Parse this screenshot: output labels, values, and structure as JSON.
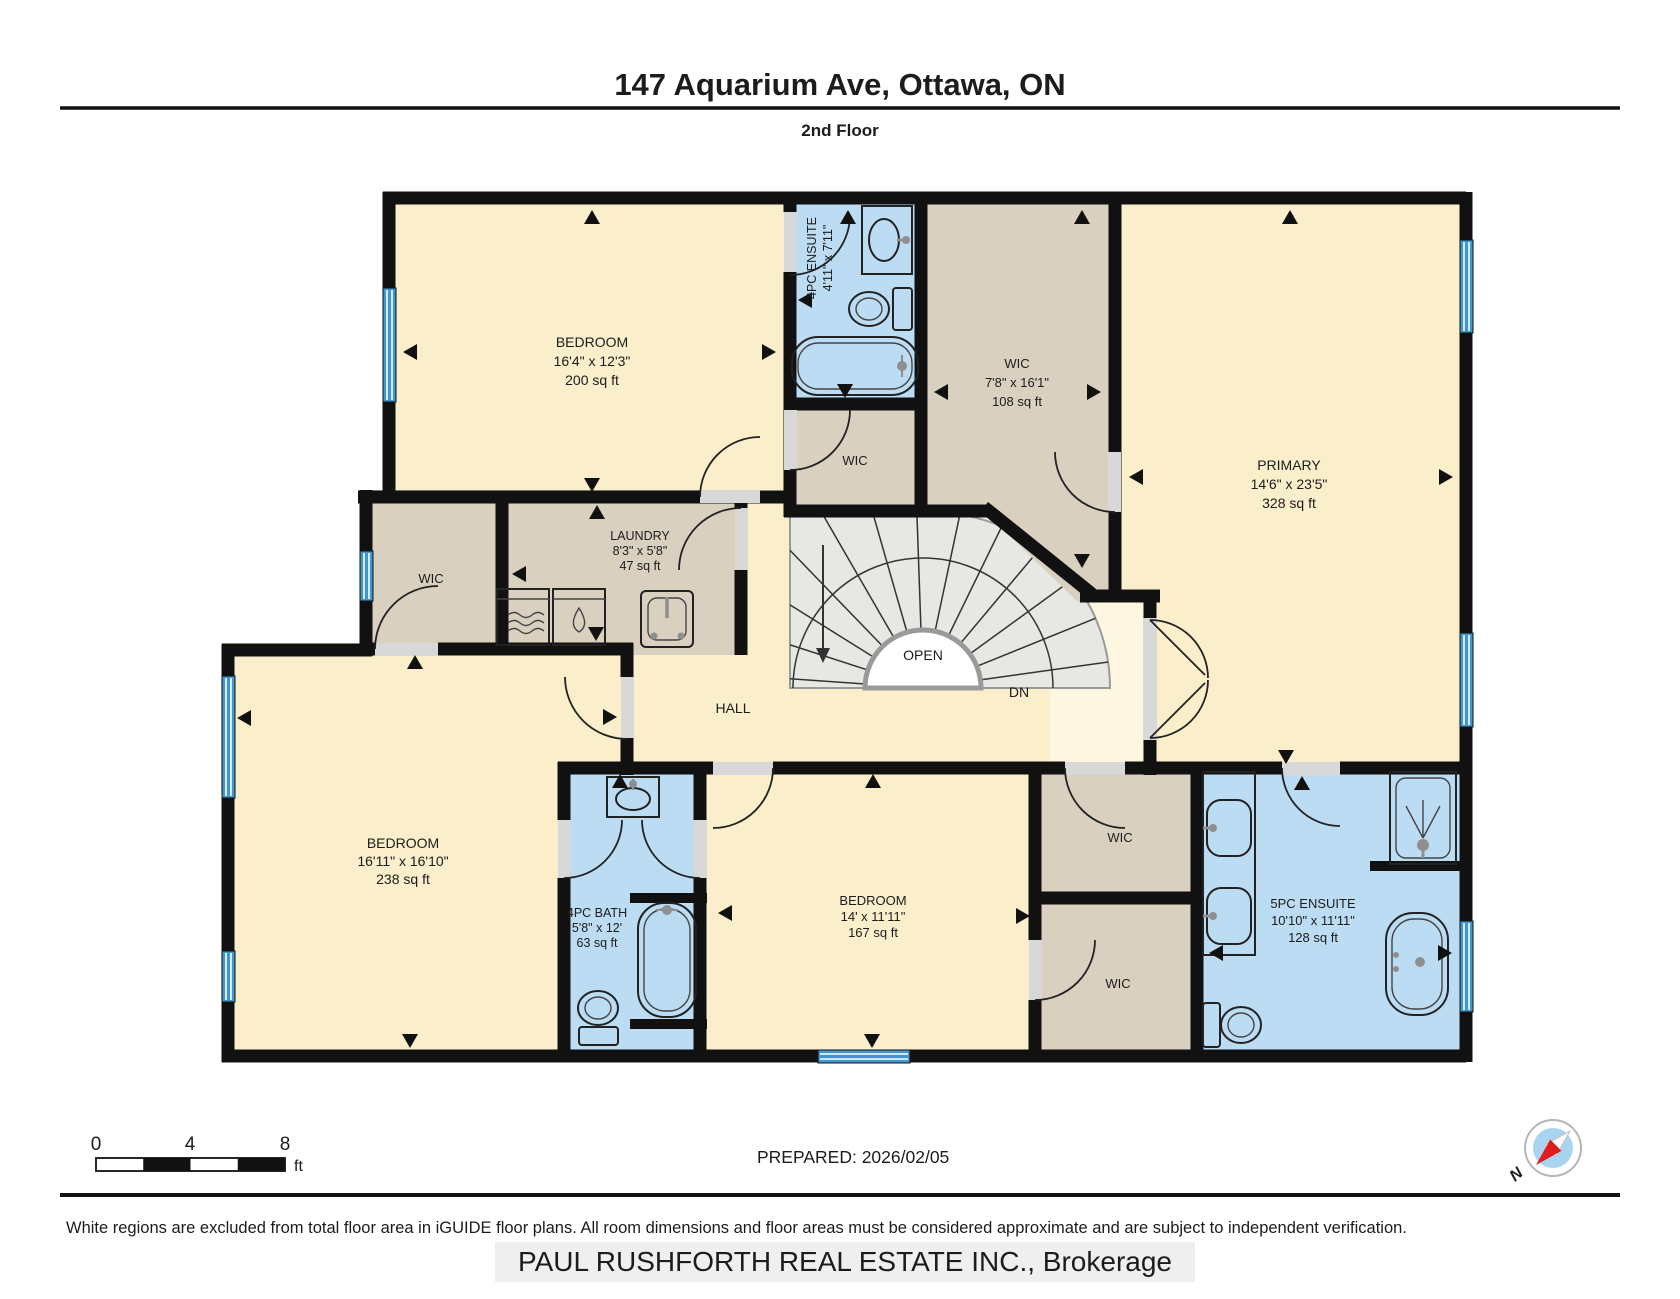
{
  "header": {
    "title": "147 Aquarium Ave, Ottawa, ON",
    "subtitle": "2nd Floor"
  },
  "rooms": {
    "bedroom_nw": {
      "name": "BEDROOM",
      "dims": "16'4\" x 12'3\"",
      "area": "200 sq ft"
    },
    "ensuite_4pc": {
      "name": "4PC ENSUITE",
      "dims": "4'11\" x 7'11\""
    },
    "wic_top": {
      "name": "WIC",
      "dims": "7'8\" x 16'1\"",
      "area": "108 sq ft"
    },
    "primary": {
      "name": "PRIMARY",
      "dims": "14'6\" x 23'5\"",
      "area": "328 sq ft"
    },
    "wic_mid": {
      "name": "WIC"
    },
    "wic_left": {
      "name": "WIC"
    },
    "laundry": {
      "name": "LAUNDRY",
      "dims": "8'3\" x 5'8\"",
      "area": "47 sq ft"
    },
    "hall": {
      "name": "HALL"
    },
    "stairs": {
      "open_label": "OPEN",
      "down_label": "DN"
    },
    "bedroom_sw": {
      "name": "BEDROOM",
      "dims": "16'11\" x 16'10\"",
      "area": "238 sq ft"
    },
    "bath_4pc": {
      "name": "4PC BATH",
      "dims": "5'8\" x 12'",
      "area": "63 sq ft"
    },
    "bedroom_s": {
      "name": "BEDROOM",
      "dims": "14' x 11'11\"",
      "area": "167 sq ft"
    },
    "wic_r_upper": {
      "name": "WIC"
    },
    "wic_r_lower": {
      "name": "WIC"
    },
    "ensuite_5pc": {
      "name": "5PC ENSUITE",
      "dims": "10'10\" x 11'11\"",
      "area": "128 sq ft"
    }
  },
  "legend": {
    "scale_ticks": [
      "0",
      "4",
      "8"
    ],
    "scale_unit": "ft",
    "prepared": "PREPARED: 2026/02/05",
    "compass_north": "N"
  },
  "footer": {
    "disclaimer": "White regions are excluded from total floor area in iGUIDE floor plans. All room dimensions and floor areas must be considered approximate and are subject to independent verification.",
    "watermark": "PAUL RUSHFORTH REAL ESTATE INC., Brokerage"
  },
  "colors": {
    "room_fill": "#faeecb",
    "closet_fill": "#d9d0c0",
    "bath_fill": "#bcdcf4",
    "wall": "#111111",
    "window": "#3f97cf",
    "stairs": "#e7e7e4",
    "compass_needle": "#e01b1b"
  }
}
